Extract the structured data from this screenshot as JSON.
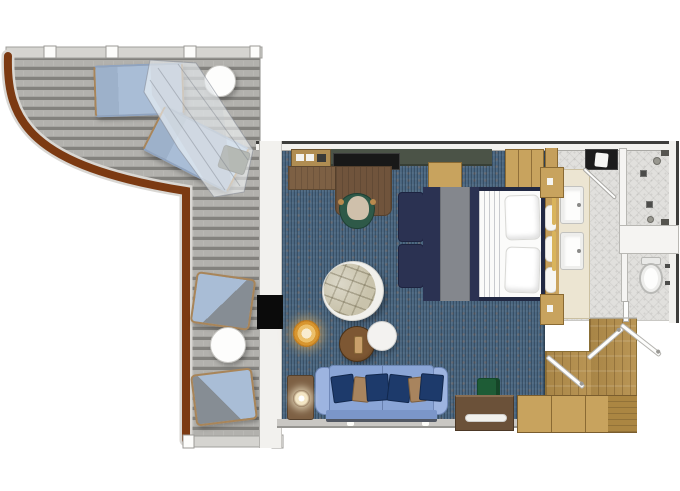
{
  "scene": {
    "description": "Top-down floor plan of a ship stateroom suite with wrap-around balcony, bedroom-living area, bathroom and entry hall"
  },
  "palette": {
    "deck": "#a6a5a1",
    "deck_light": "#b2b1ad",
    "deck_dark": "#82817d",
    "deck_wall": "#d5d4d0",
    "railing": "#7c3a12",
    "railing_edge": "#d9d7d3",
    "carpet": "#48647e",
    "carpet_dark": "#3c546b",
    "wall_white": "#f2f1ee",
    "wall_dark": "#3d3d3b",
    "wall_gray": "#c9c7c3",
    "tile": "#e1e0dd",
    "wood_light": "#c8a35e",
    "wood_mid": "#ab8642",
    "wood_floor": "#b6904c",
    "wood_desk": "#7d6044",
    "wood_dark": "#6b5139",
    "bed_navy": "#2b3252",
    "bed_runner": "#84878d",
    "linen": "#fbfbfa",
    "sofa": "#8aa5d6",
    "sofa_arm": "#9db4e0",
    "pillow_navy": "#1d3a6b",
    "pillow_tan": "#a8845e",
    "armchair": "#c9c3ac",
    "chair_green": "#2e5948",
    "ottoman_green": "#1e5c36",
    "lamp_orange": "#d8962f",
    "table_brown": "#6e4a26",
    "white_fixture": "#fdfdfc",
    "vanity_cream": "#ece5d2",
    "net": "#eef0f4",
    "door_black": "#0b0b0b",
    "lounger_blue": "#a9bdd6",
    "lounger_gray": "#868d94"
  },
  "labels": {
    "scene": "Stateroom floor plan",
    "deck": "Balcony deck",
    "railing": "Curved balcony railing",
    "deck_wall": "Balcony bulkhead",
    "lounger1": "Sun lounger",
    "lounger2": "Sun lounger",
    "canopy": "Net canopy",
    "stool": "Deck stool",
    "table_round_top": "Round balcony table",
    "chair1": "Deck chair",
    "chair2": "Deck chair",
    "table_round_bottom": "Round balcony table",
    "carpet": "Bedroom and living area carpet",
    "minibar": "Minibar cabinet",
    "shelf": "Wall shelf",
    "tv": "TV",
    "counter": "Desk counter",
    "desk": "Writing desk",
    "desk_chair": "Desk chair",
    "bench": "Bench",
    "wardrobe": "Wardrobe",
    "bed": "Double bed",
    "pillow": "Pillow",
    "ottoman": "Bed-end ottoman",
    "nightstand": "Nightstand",
    "headboard_pillow": "Headboard cushion",
    "armchair": "Round lounge chair",
    "lamp": "Table lamp",
    "coffee_table": "Round coffee table",
    "side_table_white": "Round side table",
    "sofa": "Sofa",
    "sofa_pillow": "Throw pillow",
    "side_table_lamp": "Side table with lamp",
    "green_ottoman": "Footstool",
    "console": "Console table",
    "cabinets": "Cabinet run",
    "balcony_door": "Balcony door",
    "entry_floor": "Entry hall wood floor",
    "entry_door": "Entry door leaf",
    "interior_door": "Interior door leaf",
    "tile": "Bathroom tile floor",
    "vanity": "Vanity counter",
    "sink": "Sink",
    "towel_bar": "Towel bar",
    "counter_dark": "Bathroom counter",
    "shower_door": "Shower door",
    "drain": "Floor drain",
    "shower_fitting": "Shower fitting",
    "toilet": "Toilet",
    "tp_holder": "Wall fixture",
    "wall": "Wall",
    "threshold": "Threshold"
  }
}
